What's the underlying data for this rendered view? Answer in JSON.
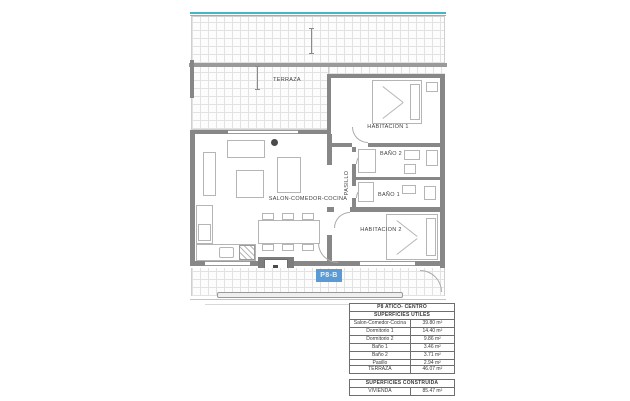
{
  "plan": {
    "unit_badge": "P8-B",
    "labels": {
      "terraza": "TERRAZA",
      "habitacion_1": "HABITACION 1",
      "bano_2": "BAÑO 2",
      "bano_1": "BAÑO 1",
      "habitacion_2": "HABITACION 2",
      "salon": "SALON-COMEDOR-COCINA",
      "pasillo": "PASILLO"
    },
    "colors": {
      "badge_blue": "#5b9bd5",
      "rail_teal": "#41b7c8",
      "wall_gray": "#878787"
    }
  },
  "tables": {
    "useful": {
      "title": "P8 ATICO- CENTRO",
      "subtitle": "SUPERFICIES UTILES",
      "rows": [
        {
          "label": "Salon-Comedor-Cocina",
          "value": "39.80 m²"
        },
        {
          "label": "Dormitorio 1",
          "value": "14.40 m²"
        },
        {
          "label": "Dormitorio 2",
          "value": "9.86 m²"
        },
        {
          "label": "Baño 1",
          "value": "3.46 m²"
        },
        {
          "label": "Baño 2",
          "value": "3.71 m²"
        },
        {
          "label": "Pasillo",
          "value": "2.94 m²"
        }
      ]
    },
    "terrace": {
      "label": "TERRAZA",
      "value": "46.07 m²"
    },
    "built": {
      "title": "SUPERFICIES CONSTRUIDA",
      "rows": [
        {
          "label": "VIVIENDA",
          "value": "85.47 m²"
        }
      ]
    }
  }
}
